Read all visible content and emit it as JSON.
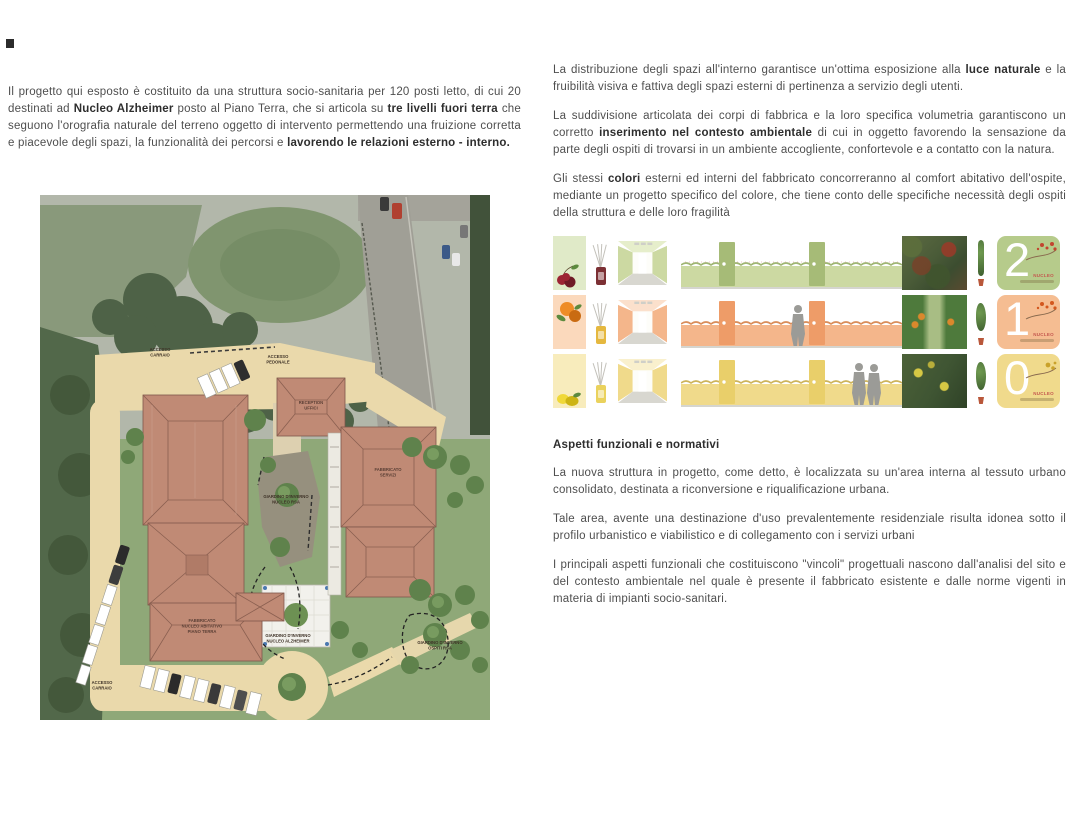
{
  "page": {
    "background": "#ffffff"
  },
  "left_column": {
    "intro": {
      "segments": [
        {
          "text": "Il progetto qui esposto è costituito da una struttura socio-sanitaria per 120 posti letto, di cui 20 destinati ad ",
          "bold": false
        },
        {
          "text": "Nucleo Alzheimer",
          "bold": true
        },
        {
          "text": " posto al Piano Terra, che si articola su ",
          "bold": false
        },
        {
          "text": "tre livelli fuori terra",
          "bold": true
        },
        {
          "text": " che seguono l'orografia naturale del terreno oggetto di intervento permettendo una fruizione corretta e piacevole degli spazi, la funzionalità dei percorsi e ",
          "bold": false
        },
        {
          "text": "lavorendo le relazioni esterno - interno.",
          "bold": true
        }
      ]
    },
    "site_plan": {
      "labels": [
        {
          "lines": [
            "ACCESSO",
            "CARRAIO"
          ]
        },
        {
          "lines": [
            "ACCESSO",
            "PEDONALE"
          ]
        },
        {
          "lines": [
            "RECEPTION",
            "UFFICI"
          ]
        },
        {
          "lines": [
            "FABBRICATO",
            "SERVIZI"
          ]
        },
        {
          "lines": [
            "FABBRICATO",
            "NUCLEO ABITATIVO",
            "PIANO TERRA"
          ]
        },
        {
          "lines": [
            "GIARDINO D'INVERNO",
            "NUCLEO RSA"
          ]
        },
        {
          "lines": [
            "GIARDINO D'INVERNO",
            "NUCLEO ALZHEIMER"
          ]
        },
        {
          "lines": [
            "GIARDINO D'INVERNO",
            "OSPITI RSA"
          ]
        },
        {
          "lines": [
            "ACCESSO",
            "CARRAIO"
          ]
        }
      ]
    }
  },
  "right_column": {
    "paragraphs": [
      {
        "segments": [
          {
            "text": "La distribuzione degli spazi all'interno garantisce un'ottima esposizione alla ",
            "bold": false
          },
          {
            "text": "luce naturale",
            "bold": true
          },
          {
            "text": " e la fruibilità visiva e fattiva degli spazi esterni di pertinenza a servizio degli utenti.",
            "bold": false
          }
        ]
      },
      {
        "segments": [
          {
            "text": "La suddivisione articolata dei corpi di fabbrica e la loro specifica volumetria garantiscono un corretto ",
            "bold": false
          },
          {
            "text": "inserimento nel contesto ambientale",
            "bold": true
          },
          {
            "text": " di cui in oggetto favorendo la sensazione da parte degli ospiti di trovarsi in un ambiente accogliente, confortevole e a contatto con la natura.",
            "bold": false
          }
        ]
      },
      {
        "segments": [
          {
            "text": "Gli stessi ",
            "bold": false
          },
          {
            "text": "colori",
            "bold": true
          },
          {
            "text": " esterni ed interni del fabbricato concorreranno al comfort abitativo dell'ospite, mediante un progetto specifico del colore, che tiene conto delle specifiche necessità degli ospiti della struttura e delle loro fragilità",
            "bold": false
          }
        ]
      }
    ],
    "palette_strips": [
      {
        "level_number": "2",
        "caption": "NUCLEO",
        "theme": "green-cherries",
        "colors": {
          "swatch": "#e0eac8",
          "wall": "#ccd9a2",
          "wallLight": "#e6eecb",
          "door": "#a6bb77",
          "badge": "#b6cb8b",
          "hedge": "#9fb573",
          "bottle": "#7c3034",
          "fruit": "#9c2433",
          "fruitDark": "#6f1a26",
          "leaf": "#5c8a3e",
          "dot": "#c2452f"
        }
      },
      {
        "level_number": "1",
        "caption": "NUCLEO",
        "theme": "orange-oranges",
        "colors": {
          "swatch": "#fbd9bc",
          "wall": "#f4b68b",
          "wallLight": "#fbe0cc",
          "door": "#ee9c68",
          "badge": "#f5bd92",
          "hedge": "#d98d5a",
          "bottle": "#e5b83f",
          "fruit": "#ee8c27",
          "fruitDark": "#c96b12",
          "leaf": "#5c8a3e",
          "dot": "#d3571e"
        }
      },
      {
        "level_number": "0",
        "caption": "NUCLEO",
        "theme": "yellow-lemons",
        "colors": {
          "swatch": "#f8ecbc",
          "wall": "#f0da8b",
          "wallLight": "#f9f0cd",
          "door": "#e9cf6a",
          "badge": "#f0da8c",
          "hedge": "#cdb35a",
          "bottle": "#ead25d",
          "fruit": "#f0d838",
          "fruitDark": "#cdb414",
          "leaf": "#5c8a3e",
          "dot": "#c9a22b"
        }
      }
    ],
    "section": {
      "heading": "Aspetti funzionali e normativi",
      "paragraphs": [
        "La nuova struttura in progetto, come detto, è localizzata su un'area interna al tessuto urbano consolidato, destinata a riconversione e riqualificazione urbana.",
        "Tale area, avente una destinazione d'uso prevalentemente residenziale risulta idonea sotto il profilo urbanistico e viabilistico e di collegamento con i servizi urbani",
        "I principali aspetti funzionali che costituiscono \"vincoli\" progettuali nascono dall'analisi del sito e del contesto ambientale nel quale è presente il fabbricato esistente e dalle norme vigenti in materia di impianti socio-sanitari."
      ]
    }
  }
}
